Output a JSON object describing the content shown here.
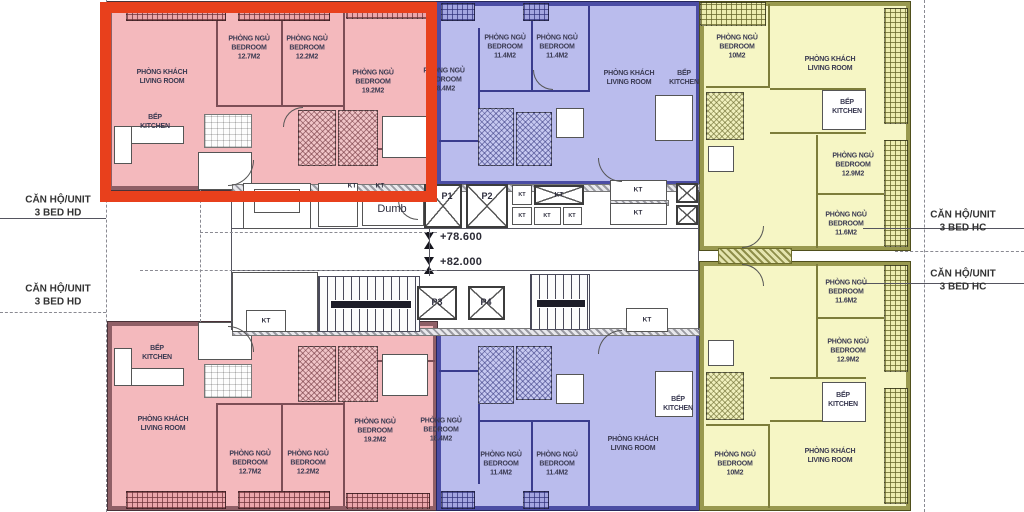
{
  "palette": {
    "pink_fill": "#f4b9bd",
    "blue_fill": "#babced",
    "yellow_fill": "#f6f6c5",
    "highlight_red": "#e8401c"
  },
  "side_labels": {
    "hd": {
      "line1": "CĂN HỘ/UNIT",
      "line2": "3 BED HD"
    },
    "hc": {
      "line1": "CĂN HỘ/UNIT",
      "line2": "3 BED HC"
    }
  },
  "core": {
    "kt": "KT",
    "dumbwaiter": "Dumb",
    "levels": {
      "upper": "+78.600",
      "lower": "+82.000"
    },
    "elevators": {
      "p1": "P1",
      "p2": "P2",
      "p3": "P3",
      "p4": "P4"
    }
  },
  "rooms": {
    "pt_living": {
      "vn": "PHÒNG KHÁCH",
      "en": "LIVING ROOM"
    },
    "pt_bed1": {
      "vn": "PHÒNG NGỦ",
      "en": "BEDROOM",
      "area": "12.7M2"
    },
    "pt_bed2": {
      "vn": "PHÒNG NGỦ",
      "en": "BEDROOM",
      "area": "12.2M2"
    },
    "pt_bed3": {
      "vn": "PHÒNG NGỦ",
      "en": "BEDROOM",
      "area": "19.2M2"
    },
    "pt_kitchen": {
      "vn": "BẾP",
      "en": "KITCHEN"
    },
    "pb_living": {
      "vn": "PHÒNG KHÁCH",
      "en": "LIVING ROOM"
    },
    "pb_bed1": {
      "vn": "PHÒNG NGỦ",
      "en": "BEDROOM",
      "area": "12.7M2"
    },
    "pb_bed2": {
      "vn": "PHÒNG NGỦ",
      "en": "BEDROOM",
      "area": "12.2M2"
    },
    "pb_bed3": {
      "vn": "PHÒNG NGỦ",
      "en": "BEDROOM",
      "area": "19.2M2"
    },
    "pb_kitchen": {
      "vn": "BẾP",
      "en": "KITCHEN"
    },
    "bt_bedL": {
      "vn": "PHÒNG NGỦ",
      "en": "BEDROOM",
      "area": "18.4M2"
    },
    "bt_bed1": {
      "vn": "PHÒNG NGỦ",
      "en": "BEDROOM",
      "area": "11.4M2"
    },
    "bt_bed2": {
      "vn": "PHÒNG NGỦ",
      "en": "BEDROOM",
      "area": "11.4M2"
    },
    "bt_living": {
      "vn": "PHÒNG KHÁCH",
      "en": "LIVING ROOM"
    },
    "bt_kitchen": {
      "vn": "BẾP",
      "en": "KITCHEN"
    },
    "bb_bedL": {
      "vn": "PHÒNG NGỦ",
      "en": "BEDROOM",
      "area": "18.4M2"
    },
    "bb_bed1": {
      "vn": "PHÒNG NGỦ",
      "en": "BEDROOM",
      "area": "11.4M2"
    },
    "bb_bed2": {
      "vn": "PHÒNG NGỦ",
      "en": "BEDROOM",
      "area": "11.4M2"
    },
    "bb_living": {
      "vn": "PHÒNG KHÁCH",
      "en": "LIVING ROOM"
    },
    "bb_kitchen": {
      "vn": "BẾP",
      "en": "KITCHEN"
    },
    "yt_bed1": {
      "vn": "PHÒNG NGỦ",
      "en": "BEDROOM",
      "area": "10M2"
    },
    "yt_living": {
      "vn": "PHÒNG KHÁCH",
      "en": "LIVING ROOM"
    },
    "yt_kitchen": {
      "vn": "BẾP",
      "en": "KITCHEN"
    },
    "yt_bed2": {
      "vn": "PHÒNG NGỦ",
      "en": "BEDROOM",
      "area": "12.9M2"
    },
    "yt_bed3": {
      "vn": "PHÒNG NGỦ",
      "en": "BEDROOM",
      "area": "11.6M2"
    },
    "yb_bed3": {
      "vn": "PHÒNG NGỦ",
      "en": "BEDROOM",
      "area": "11.6M2"
    },
    "yb_bed2": {
      "vn": "PHÒNG NGỦ",
      "en": "BEDROOM",
      "area": "12.9M2"
    },
    "yb_kitchen": {
      "vn": "BẾP",
      "en": "KITCHEN"
    },
    "yb_living": {
      "vn": "PHÒNG KHÁCH",
      "en": "LIVING ROOM"
    },
    "yb_bed1": {
      "vn": "PHÒNG NGỦ",
      "en": "BEDROOM",
      "area": "10M2"
    }
  }
}
